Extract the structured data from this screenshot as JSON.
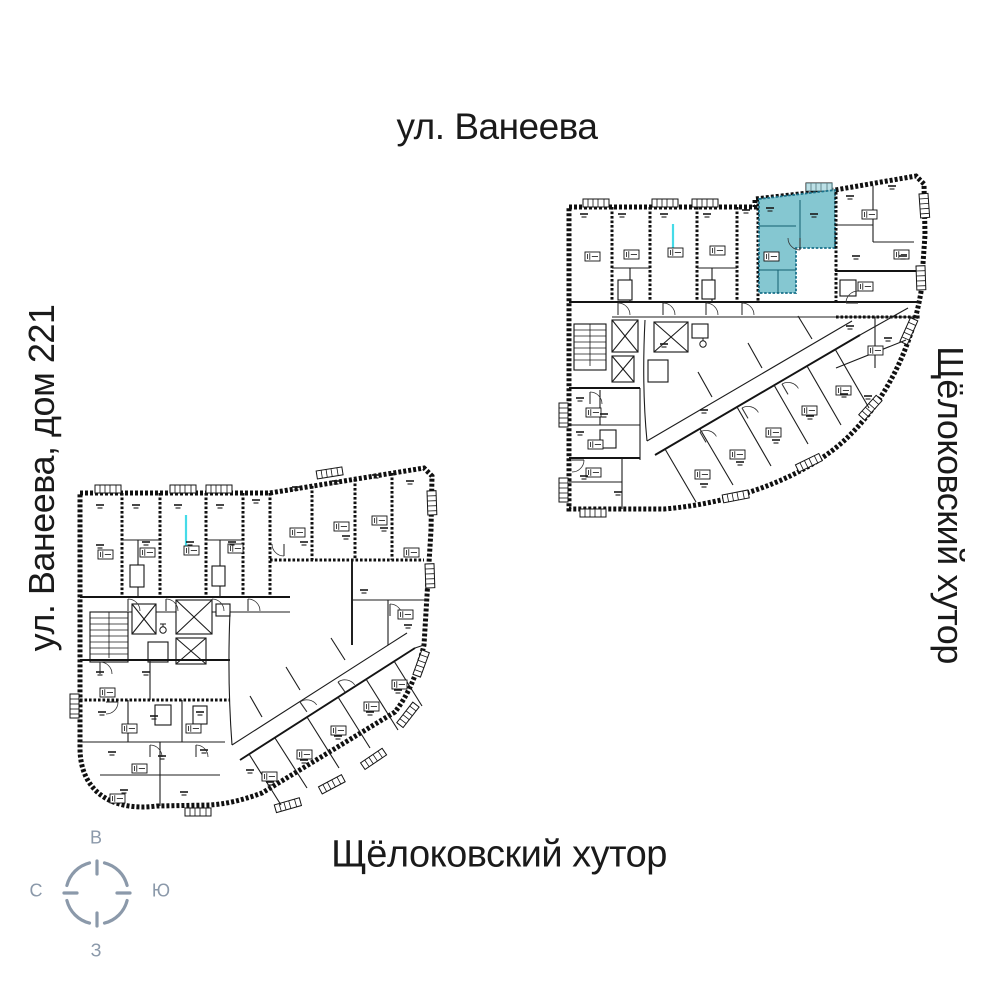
{
  "labels": {
    "street_top": "ул. Ванеева",
    "street_left": "ул. Ванеева, дом 221",
    "area_right": "Щёлоковский хутор",
    "area_bottom": "Щёлоковский хутор"
  },
  "compass": {
    "top": "В",
    "right": "Ю",
    "bottom": "З",
    "left": "С"
  },
  "colors": {
    "highlight": "#85c7d1",
    "highlight_border": "#19718a",
    "compass": "#8b99aa",
    "text": "#1a1a1a",
    "plan_line": "#101010",
    "utility_marker": "#45dbe8",
    "background": "#ffffff"
  },
  "plans": {
    "upper": {
      "position": "top-right",
      "has_highlighted_unit": true
    },
    "lower": {
      "position": "bottom-left",
      "has_highlighted_unit": false
    }
  }
}
